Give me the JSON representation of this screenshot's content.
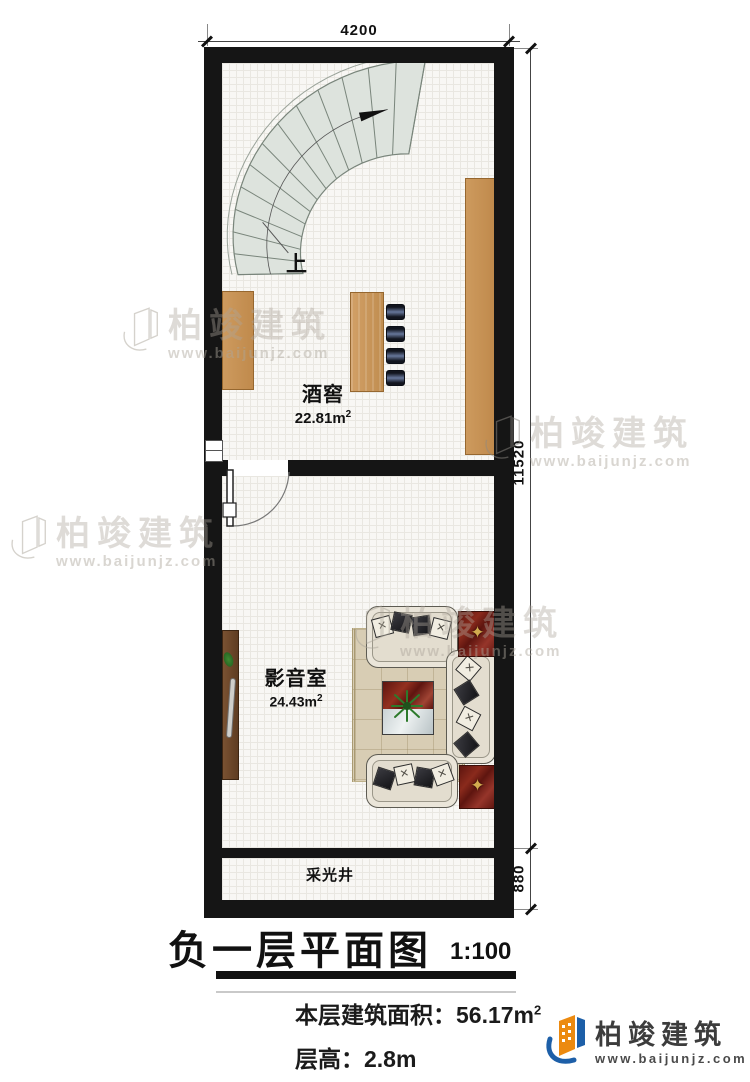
{
  "plan": {
    "dimensions": {
      "top": "4200",
      "right_total": "11520",
      "right_lightwell": "880"
    },
    "rooms": [
      {
        "label": "酒窖",
        "area": "22.81m",
        "area_sup": "2"
      },
      {
        "label": "影音室",
        "area": "24.43m",
        "area_sup": "2"
      },
      {
        "label": "采光井"
      }
    ],
    "stair_direction_label": "上"
  },
  "title_block": {
    "title": "负一层平面图",
    "scale": "1:100",
    "area_label": "本层建筑面积：",
    "area_value": "56.17m",
    "area_sup": "2",
    "height_label": "层高：",
    "height_value": "2.8m"
  },
  "brand": {
    "name": "柏竣建筑",
    "url": "www.baijunjz.com"
  },
  "watermark": {
    "text": "柏竣建筑",
    "url": "www.baijunjz.com"
  },
  "colors": {
    "wall": "#151515",
    "wood": "#c68e52",
    "stair_fill": "#dde3dd",
    "sofa": "#eae5d9",
    "rug": "#d8cdb4",
    "mat_red": "#6e1a12",
    "ornament_gold": "#caa24a",
    "brand_orange": "#ec8a10",
    "brand_blue": "#1d5fa8"
  }
}
